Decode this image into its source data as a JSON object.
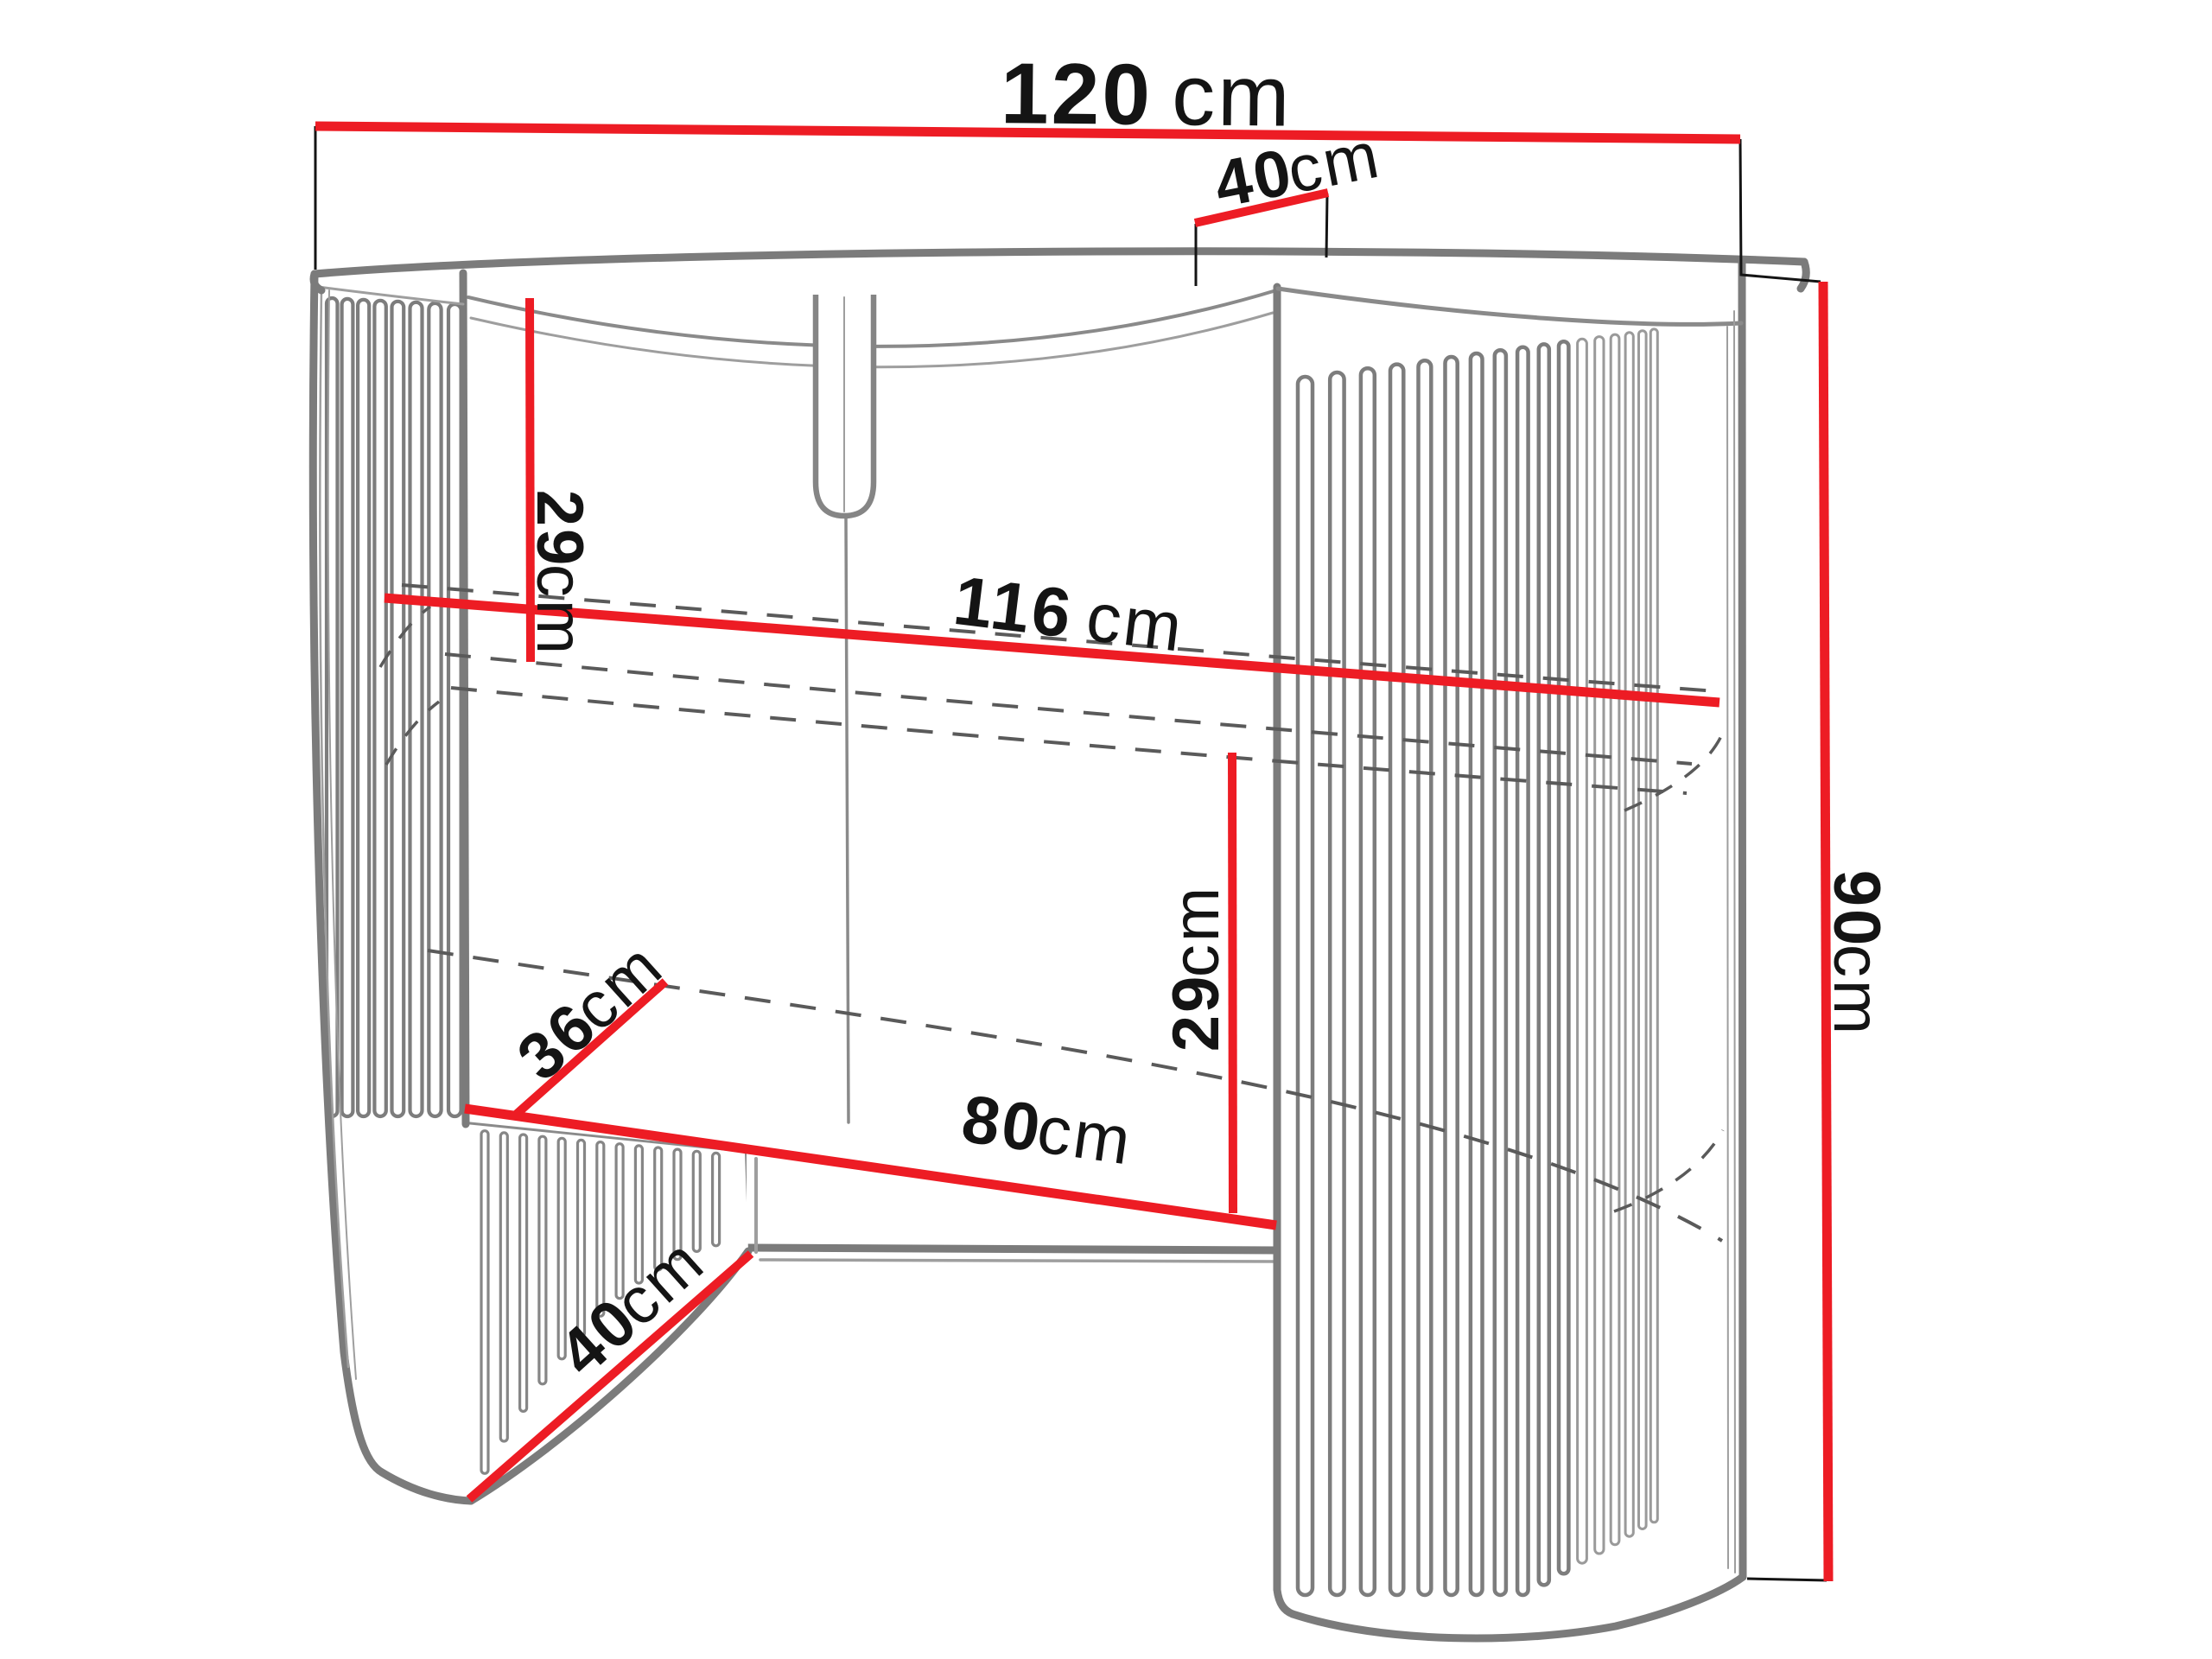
{
  "diagram": {
    "title": "fluted-console-dimension-diagram",
    "units": "cm",
    "colors": {
      "dimension_line": "#ED1C24",
      "outline_gray": "#7B7B7B",
      "label_text": "#141414",
      "background": "#FFFFFF",
      "dashed_line": "#5A5A5A"
    },
    "labels": {
      "width_top": {
        "num": "120",
        "unit": "cm",
        "value": 120
      },
      "depth_top": {
        "num": "40",
        "unit": "cm",
        "value": 40
      },
      "clearance_upper": {
        "num": "29",
        "unit": "cm",
        "value": 29
      },
      "inner_width": {
        "num": "116",
        "unit": "cm",
        "value": 116
      },
      "shelf_depth": {
        "num": "36",
        "unit": "cm",
        "value": 36
      },
      "clearance_lower": {
        "num": "29",
        "unit": "cm",
        "value": 29
      },
      "opening_width": {
        "num": "80",
        "unit": "cm",
        "value": 80
      },
      "base_depth": {
        "num": "40",
        "unit": "cm",
        "value": 40
      },
      "height": {
        "num": "90",
        "unit": "cm",
        "value": 90
      }
    }
  }
}
